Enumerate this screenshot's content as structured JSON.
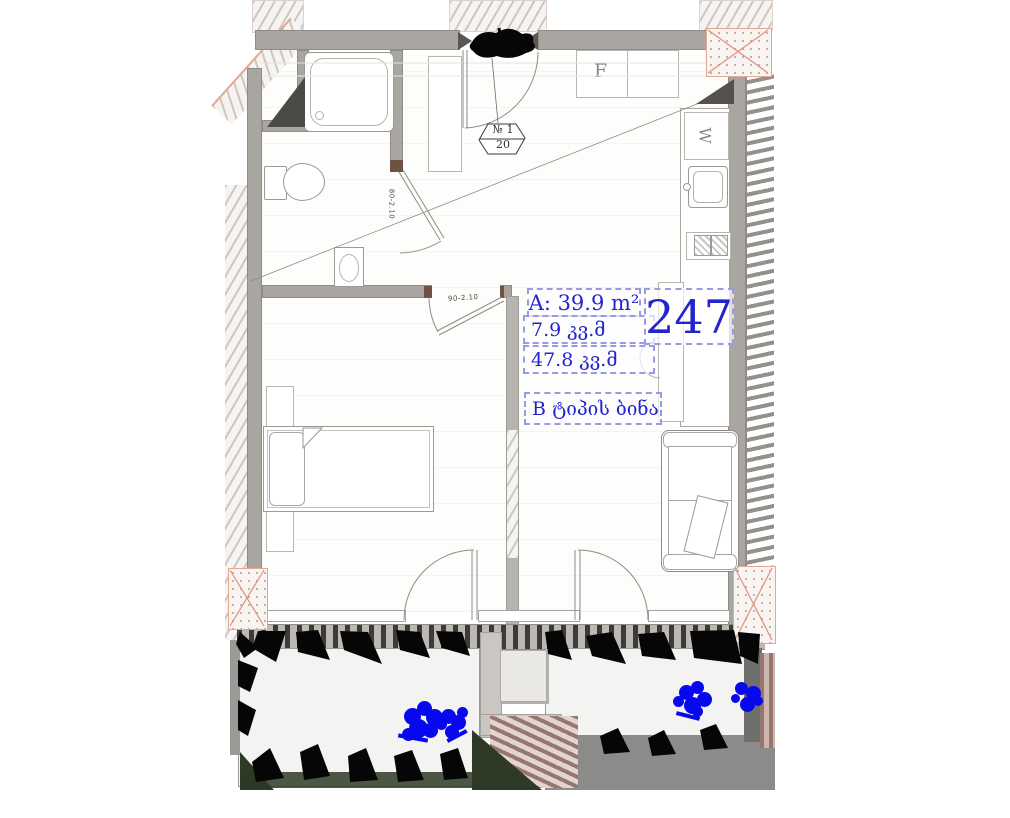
{
  "plan": {
    "annotations": {
      "area_main": "A: 39.9 m²",
      "area_balcony": "7.9 კვ.მ",
      "area_total": "47.8 კვ.მ",
      "apartment_number": "247",
      "apartment_type": "B ტიპის ბინა"
    },
    "badge": {
      "number": "№ 1",
      "capacity": "20"
    },
    "labels": {
      "fridge": "F",
      "washer": "W",
      "door_main": "90-2.10",
      "door_bath": "80-2.10"
    },
    "colors": {
      "annotation_blue": "#2424cf",
      "annotation_border": "#9a9ae2",
      "wall_gray": "#a9a6a2",
      "column_cross_red": "#e09080",
      "flower_blue": "#0808ee",
      "plant_black": "#060606",
      "grass_green": "#2e3a26"
    }
  }
}
